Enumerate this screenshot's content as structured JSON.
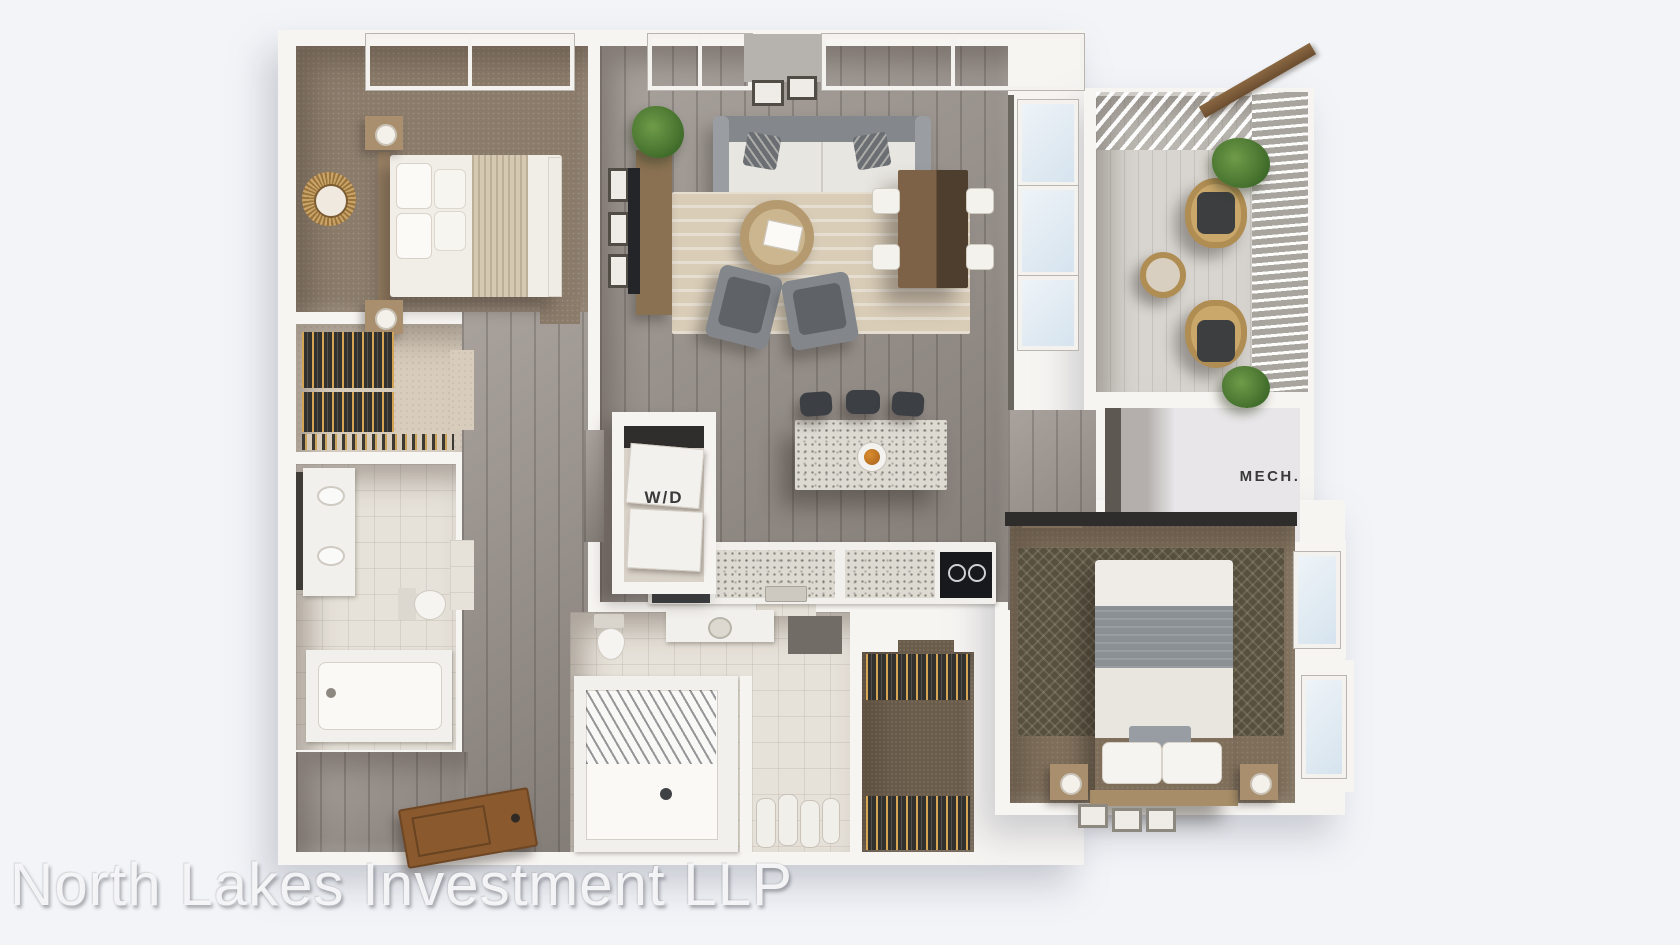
{
  "scene": {
    "type": "3d-apartment-floor-plan-rendering",
    "watermark": "North Lakes Investment LLP"
  },
  "labels": {
    "washer_dryer": "W/D",
    "mech_room": "MECH."
  },
  "colors": {
    "background": "#f2f4f8",
    "exterior_wall": "#f7f5f2",
    "wood_floor": "#98908a",
    "bedroom_carpet": "#8b7b6a",
    "tile_floor": "#e7e2d9",
    "terrazzo_counter": "#dddad2",
    "sofa_gray": "#84888d",
    "plant_green": "#4e7a36",
    "entry_door_wood": "#8a5a2e",
    "pergola_beam_wood": "#7b5a38",
    "wicker_tan": "#b08d52",
    "label_text": "#3a3a3a",
    "watermark_text": "#f8f8fa"
  }
}
